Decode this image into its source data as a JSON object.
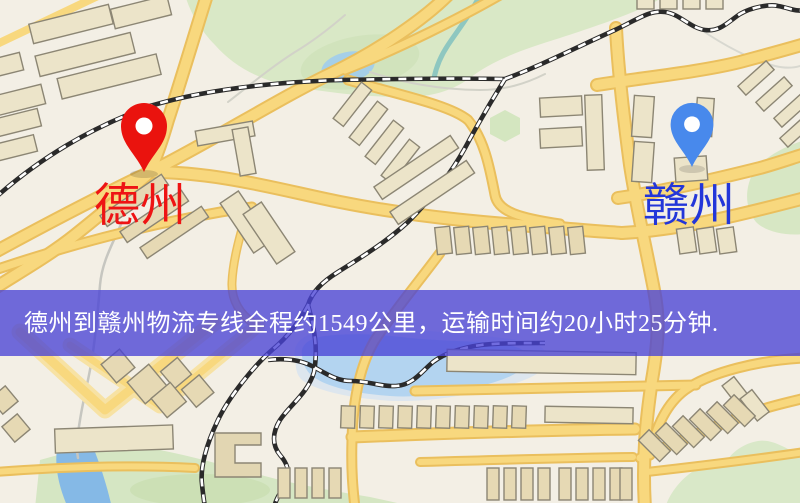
{
  "map": {
    "origin": {
      "label": "德州",
      "label_color": "#ee1414",
      "pin_color": "#ea130e"
    },
    "destination": {
      "label": "赣州",
      "label_color": "#2336d9",
      "pin_color": "#4889ec"
    }
  },
  "banner": {
    "text": "德州到赣州物流专线全程约1549公里，运输时间约20小时25分钟.",
    "bg_color": "#4943d6",
    "text_color": "#ffffff"
  },
  "palette": {
    "map_background": "#f3efe5",
    "road_fill": "#f8d87e",
    "road_edge": "#eabf5d",
    "railway": "#2a2a2a",
    "park_green": "#d9e8c6",
    "water_blue": "#a5cfe8",
    "building_fill": "#ece4c9"
  }
}
